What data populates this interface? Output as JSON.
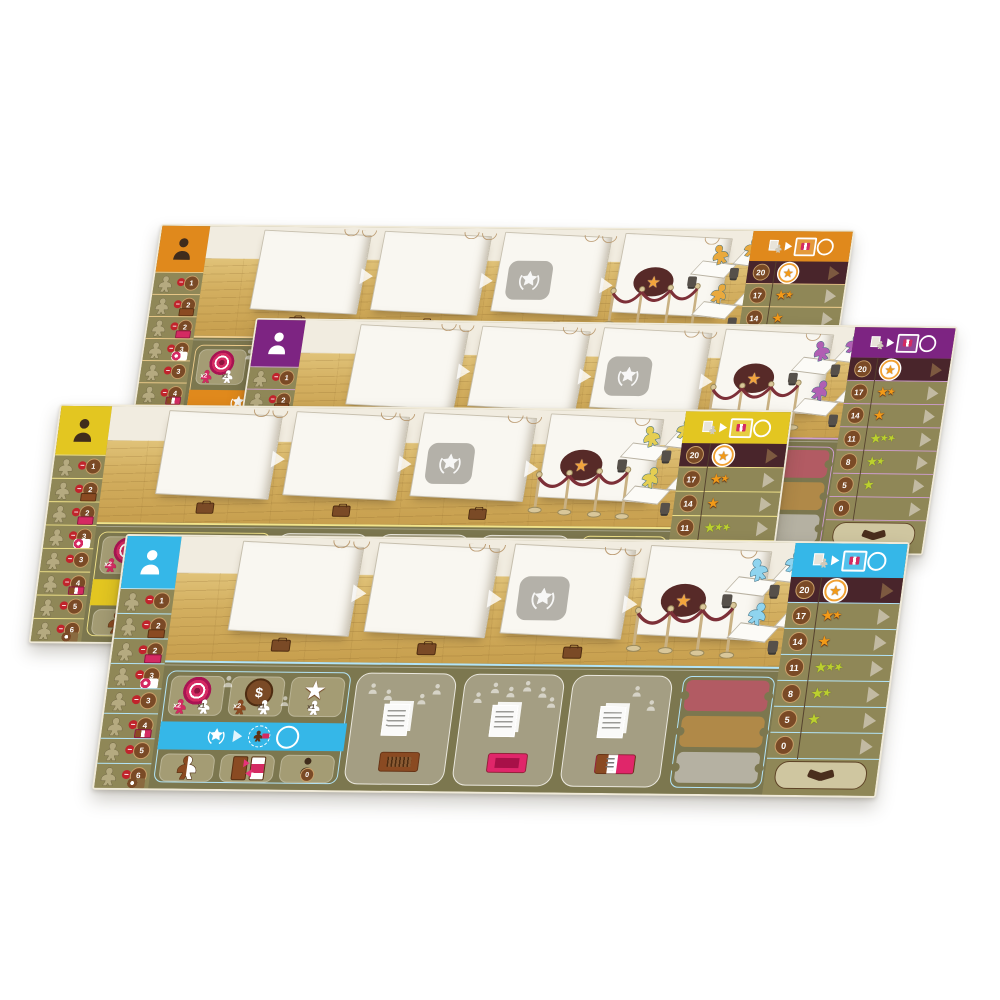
{
  "scene_title": "Four museum exhibition player boards",
  "boards": [
    {
      "id": "orange",
      "player_color": "#e0891c",
      "player_color_light": "#f2cf8e",
      "meeple_color": "#e9a93d",
      "person_icon_dark": true
    },
    {
      "id": "purple",
      "player_color": "#7d2482",
      "player_color_light": "#cf9ed1",
      "meeple_color": "#b05fb3",
      "person_icon_dark": false
    },
    {
      "id": "yellow",
      "player_color": "#e3c621",
      "player_color_light": "#f2e48a",
      "meeple_color": "#e5ce52",
      "person_icon_dark": true
    },
    {
      "id": "blue",
      "player_color": "#35b7e8",
      "player_color_light": "#b3e4f7",
      "meeple_color": "#8fd4ef",
      "person_icon_dark": false
    }
  ],
  "board_template": {
    "left_column": {
      "player_icon": "person-icon",
      "penalty_rows": [
        {
          "value": "-1",
          "extra": null
        },
        {
          "value": "-2",
          "extra": "brown-ticket"
        },
        {
          "value": "-2",
          "extra": "pink-ticket"
        },
        {
          "value": "-3",
          "extra": "target-meeple"
        },
        {
          "value": "-3",
          "extra": null
        },
        {
          "value": "-4",
          "extra": "striped-ticket"
        },
        {
          "value": "-5",
          "extra": null
        },
        {
          "value": "-6",
          "extra": "coin-meeple"
        }
      ]
    },
    "gallery": {
      "walls": 4,
      "icons": [
        "laurel-star-plaque",
        "rosette-star-oval",
        "rope-barrier",
        "bench",
        "desks-with-meeples"
      ]
    },
    "score_track": {
      "header_icons": [
        "cards-meeple-icon",
        "arrow-right-icon",
        "framed-ticket-icon",
        "ring-icon"
      ],
      "rows": [
        {
          "value": "20",
          "stars": 1,
          "star_color": "orange",
          "rosette": true
        },
        {
          "value": "17",
          "stars": 2,
          "star_color": "orange",
          "rosette": false
        },
        {
          "value": "14",
          "stars": 1,
          "star_color": "orange",
          "rosette": false
        },
        {
          "value": "11",
          "stars": 3,
          "star_color": "green",
          "rosette": false
        },
        {
          "value": "8",
          "stars": 2,
          "star_color": "green",
          "rosette": false
        },
        {
          "value": "5",
          "stars": 1,
          "star_color": "green",
          "rosette": false
        },
        {
          "value": "0",
          "stars": 0,
          "star_color": null,
          "rosette": false
        }
      ],
      "bottom_icon": "handshake-icon"
    },
    "action_panel": {
      "coin_symbol": "$",
      "top_tiles": [
        {
          "icon": "target-icon",
          "labels": [
            "x2",
            "x1"
          ]
        },
        {
          "icon": "coin-icon",
          "labels": [
            "x2",
            "x1"
          ]
        },
        {
          "icon": "star-icon",
          "labels": [
            "x1"
          ]
        }
      ],
      "banner_icons": [
        "laurel-star-icon",
        "arrow-right-icon",
        "dashed-circle-meeple-ticket-icon",
        "circle-icon"
      ],
      "bottom_tiles": [
        {
          "icon": "split-meeple-icon",
          "badge": null
        },
        {
          "icon": "ticket-exchange-icon",
          "badge": null
        },
        {
          "icon": "person-icon",
          "badge": "0"
        }
      ],
      "card_slots": [
        {
          "figures": 4,
          "ticket": "brown"
        },
        {
          "figures": 6,
          "ticket": "pink"
        },
        {
          "figures": 2,
          "ticket": "striped"
        }
      ],
      "big_slots": [
        "red",
        "tan",
        "gray"
      ]
    }
  }
}
